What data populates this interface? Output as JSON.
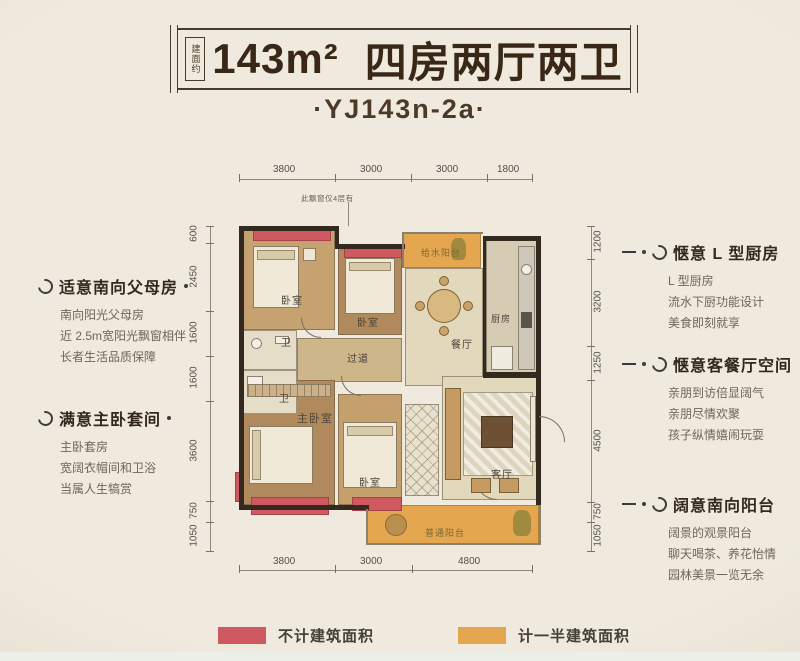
{
  "header": {
    "area_label": "建面约",
    "area": "143m²",
    "title": "四房两厅两卫",
    "subtitle": "·YJ143n-2a·"
  },
  "dims": {
    "top": [
      "3800",
      "3000",
      "3000",
      "1800"
    ],
    "bottom": [
      "3800",
      "3000",
      "4800"
    ],
    "left": [
      "600",
      "2450",
      "1600",
      "1600",
      "3600",
      "750",
      "1050"
    ],
    "right": [
      "1200",
      "3200",
      "1250",
      "4500",
      "750",
      "1050"
    ]
  },
  "plan": {
    "note": "此飘窗仅4层有",
    "rooms": {
      "bedroom1": "卧室",
      "bedroom2": "卧室",
      "bath1": "卫",
      "bath2": "卫",
      "corridor": "过道",
      "dining": "餐厅",
      "kitchen": "厨房",
      "water_balcony": "给水阳台",
      "master": "主卧室",
      "bedroom3": "卧室",
      "living": "客厅",
      "balcony": "普通阳台"
    }
  },
  "annotations": {
    "left": [
      {
        "title": "适意南向父母房",
        "lines": [
          "南向阳光父母房",
          "近 2.5m宽阳光飘窗相伴",
          "长者生活品质保障"
        ]
      },
      {
        "title": "满意主卧套间",
        "lines": [
          "主卧套房",
          "宽阔衣帽间和卫浴",
          "当属人生犒赏"
        ]
      }
    ],
    "right": [
      {
        "title": "惬意 L 型厨房",
        "lines": [
          "L 型厨房",
          "流水下厨功能设计",
          "美食即刻就享"
        ]
      },
      {
        "title": "惬意客餐厅空间",
        "lines": [
          "亲朋到访倍显阔气",
          "亲朋尽情欢聚",
          "孩子纵情嬉闹玩耍"
        ]
      },
      {
        "title": "阔意南向阳台",
        "lines": [
          "阔景的观景阳台",
          "聊天喝茶、养花怡情",
          "园林美景一览无余"
        ]
      }
    ]
  },
  "legend": {
    "items": [
      {
        "label": "不计建筑面积",
        "color": "#cf5960"
      },
      {
        "label": "计一半建筑面积",
        "color": "#e4a64f"
      }
    ]
  },
  "colors": {
    "no_area_red": "#cf5960",
    "half_area_orange": "#e4a64f",
    "title_text": "#392817",
    "background": "#eae5d8"
  }
}
